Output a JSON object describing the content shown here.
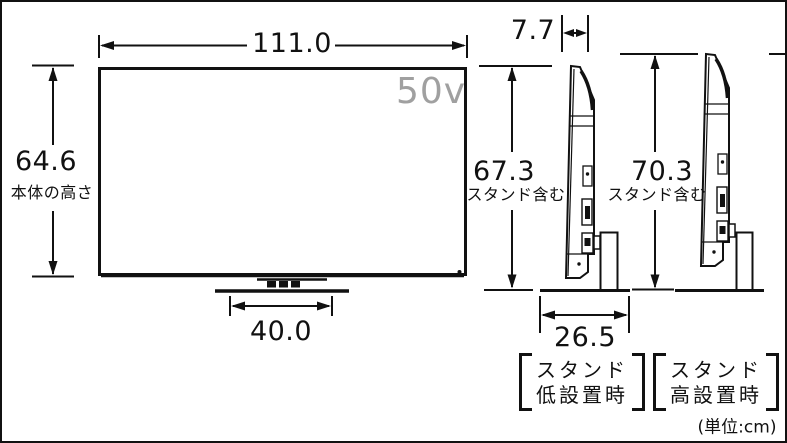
{
  "diagram": {
    "title_semantics": "TV dimensions spec drawing",
    "unit_note": "(単位:cm)",
    "front_view": {
      "screen_size_label": "50v",
      "width_cm": "111.0",
      "body_height_cm": "64.6",
      "body_height_caption": "本体の高さ",
      "stand_width_cm": "40.0"
    },
    "side_view_low": {
      "depth_cm": "7.7",
      "total_height_cm": "67.3",
      "total_height_caption": "スタンド含む",
      "stand_depth_cm": "26.5",
      "config_label_line1": "スタンド",
      "config_label_line2": "低設置時"
    },
    "side_view_high": {
      "total_height_cm": "70.3",
      "total_height_caption": "スタンド含む",
      "config_label_line1": "スタンド",
      "config_label_line2": "高設置時"
    },
    "colors": {
      "line": "#111111",
      "screen_label_gray": "#a0a0a0"
    }
  }
}
